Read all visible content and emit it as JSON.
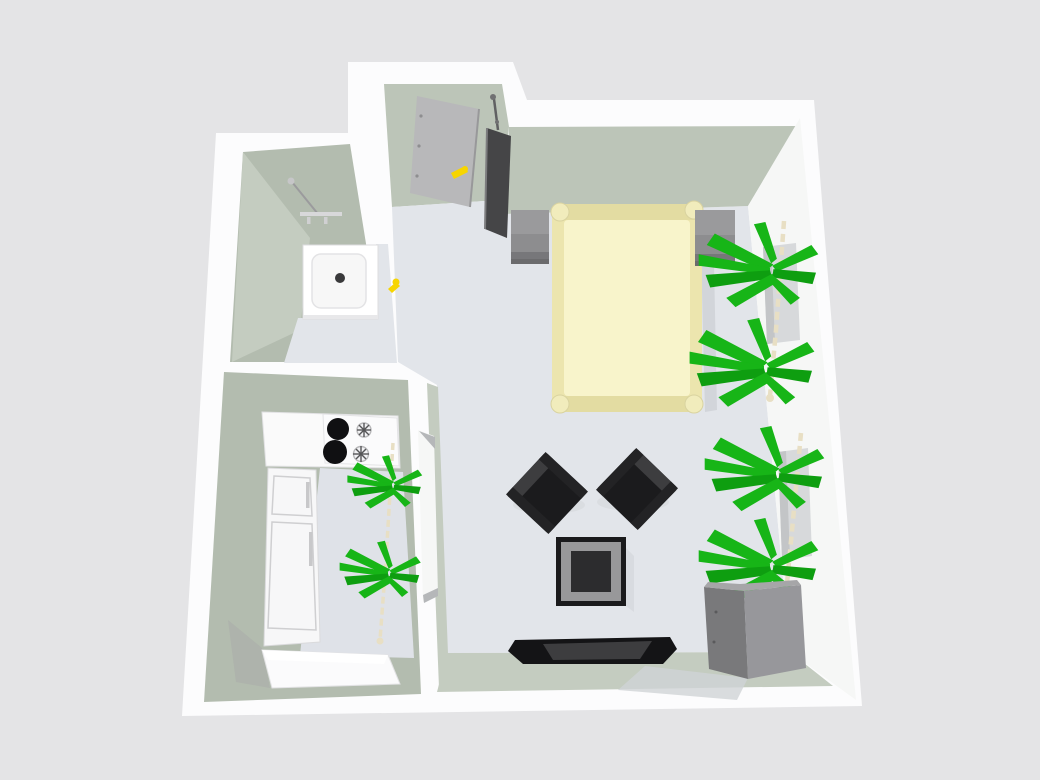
{
  "scene": {
    "view": "3d-overhead-floor-plan",
    "rooms": [
      "bathroom",
      "kitchen",
      "entry-hall",
      "living-bedroom"
    ],
    "objects": [
      "entry-door",
      "door-mirror",
      "shower-tray",
      "shower-fixture",
      "bathroom-door-handle",
      "kitchen-counter",
      "cooktop",
      "fridge",
      "base-cabinet",
      "kitchen-plant",
      "kitchen-door",
      "bed",
      "nightstand-left",
      "nightstand-right",
      "window-upper",
      "window-lower",
      "wall-plant-upper",
      "wall-plant-lower",
      "armchair-left",
      "armchair-right",
      "coffee-table",
      "media-sideboard",
      "dresser"
    ]
  },
  "palette": {
    "bg": "#e4e4e6",
    "wall_white": "#fcfcfd",
    "wall_face": "#bcc5b8",
    "wall_face_dark": "#b3bcaf",
    "wall_face_light": "#c4ccc0",
    "right_wall": "#f6f7f6",
    "floor": "#e2e5ea",
    "floor_kitchen": "#dfe2e8",
    "window_gray": "#d7d9db",
    "window_dark": "#c3c5c7",
    "bed_frame": "#ece5ae",
    "bed_rail": "#e3dca2",
    "bed_mattress": "#f8f4cb",
    "bed_post": "#f1ecbc",
    "nightstand": "#8d8d8f",
    "nightstand_top": "#9a9a9c",
    "nightstand_shadow": "#6b6b6d",
    "plant": "#17b517",
    "plant_dark": "#0e9e10",
    "trunk": "#e8dfc4",
    "chair": "#1b1b1d",
    "chair_edge": "#3d3d3f",
    "chair_side": "#232325",
    "table_frame": "#1a1a1c",
    "table_bevel": "#98989a",
    "table_center": "#2c2c2e",
    "sideboard": "#141416",
    "sideboard_top": "#3d3d3f",
    "dresser_front": "#79797b",
    "dresser_side": "#97979b",
    "door_gray": "#b8b8ba",
    "door_edge": "#98989a",
    "handle_yellow": "#f7d500",
    "mirror_dark": "#454547",
    "shadow": "#d2d5da",
    "shower_white": "#ffffff",
    "shower_inner": "#f7f7f7",
    "drain": "#39393b",
    "fixture_gray": "#9b9b9d",
    "fridge_white": "#f7f7f8",
    "fridge_line": "#cfcfd1",
    "cooktop_white": "#fbfbfc",
    "burner": "#101012"
  }
}
